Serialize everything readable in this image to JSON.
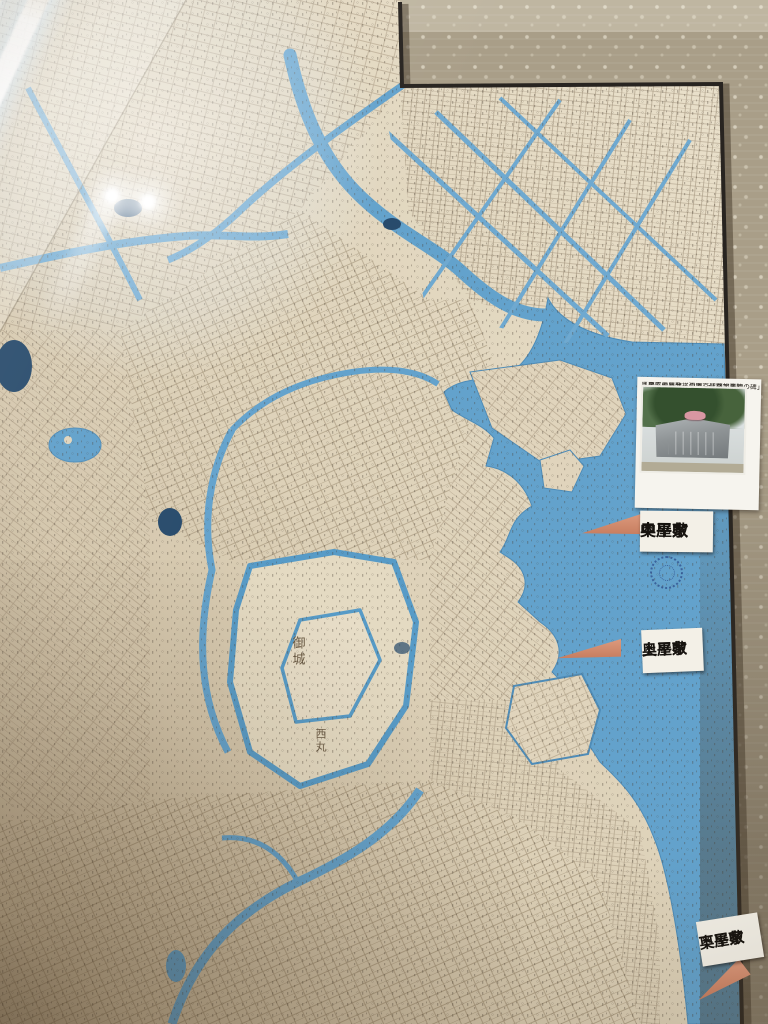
{
  "photo_card": {
    "caption_line1": "奥平家中屋敷・現東京聖路加病院",
    "caption_line2": "「慶応義塾発祥の地」・「蘭学事始の碑」"
  },
  "labels": {
    "naka": {
      "line1": "奥平家",
      "line2": "中屋敷"
    },
    "kami": {
      "line1": "奥平家",
      "line2": "上屋敷"
    },
    "shimo": {
      "line1": "奥平家",
      "line2": "下屋敷"
    }
  },
  "map_text": {
    "castle": "御城",
    "nishinomaru": "西丸"
  },
  "icons": {
    "seal": "compass-seal-stamp",
    "pointer": "marker-arrow"
  },
  "colors": {
    "water": "#63a2cc",
    "water-deep": "#4e8cb8",
    "paper": "#e2d7c0",
    "paper-dark": "#c3b295",
    "mat": "#a99e88",
    "map-edge": "#282420",
    "marker": "#d2876b",
    "label-bg": "#f3f0e7",
    "label-text": "#16130f",
    "seal-blue": "#2e4f8c",
    "tree-green": "#34502e",
    "stone-gray": "#8f9496",
    "flower-pink": "#d897a2"
  }
}
